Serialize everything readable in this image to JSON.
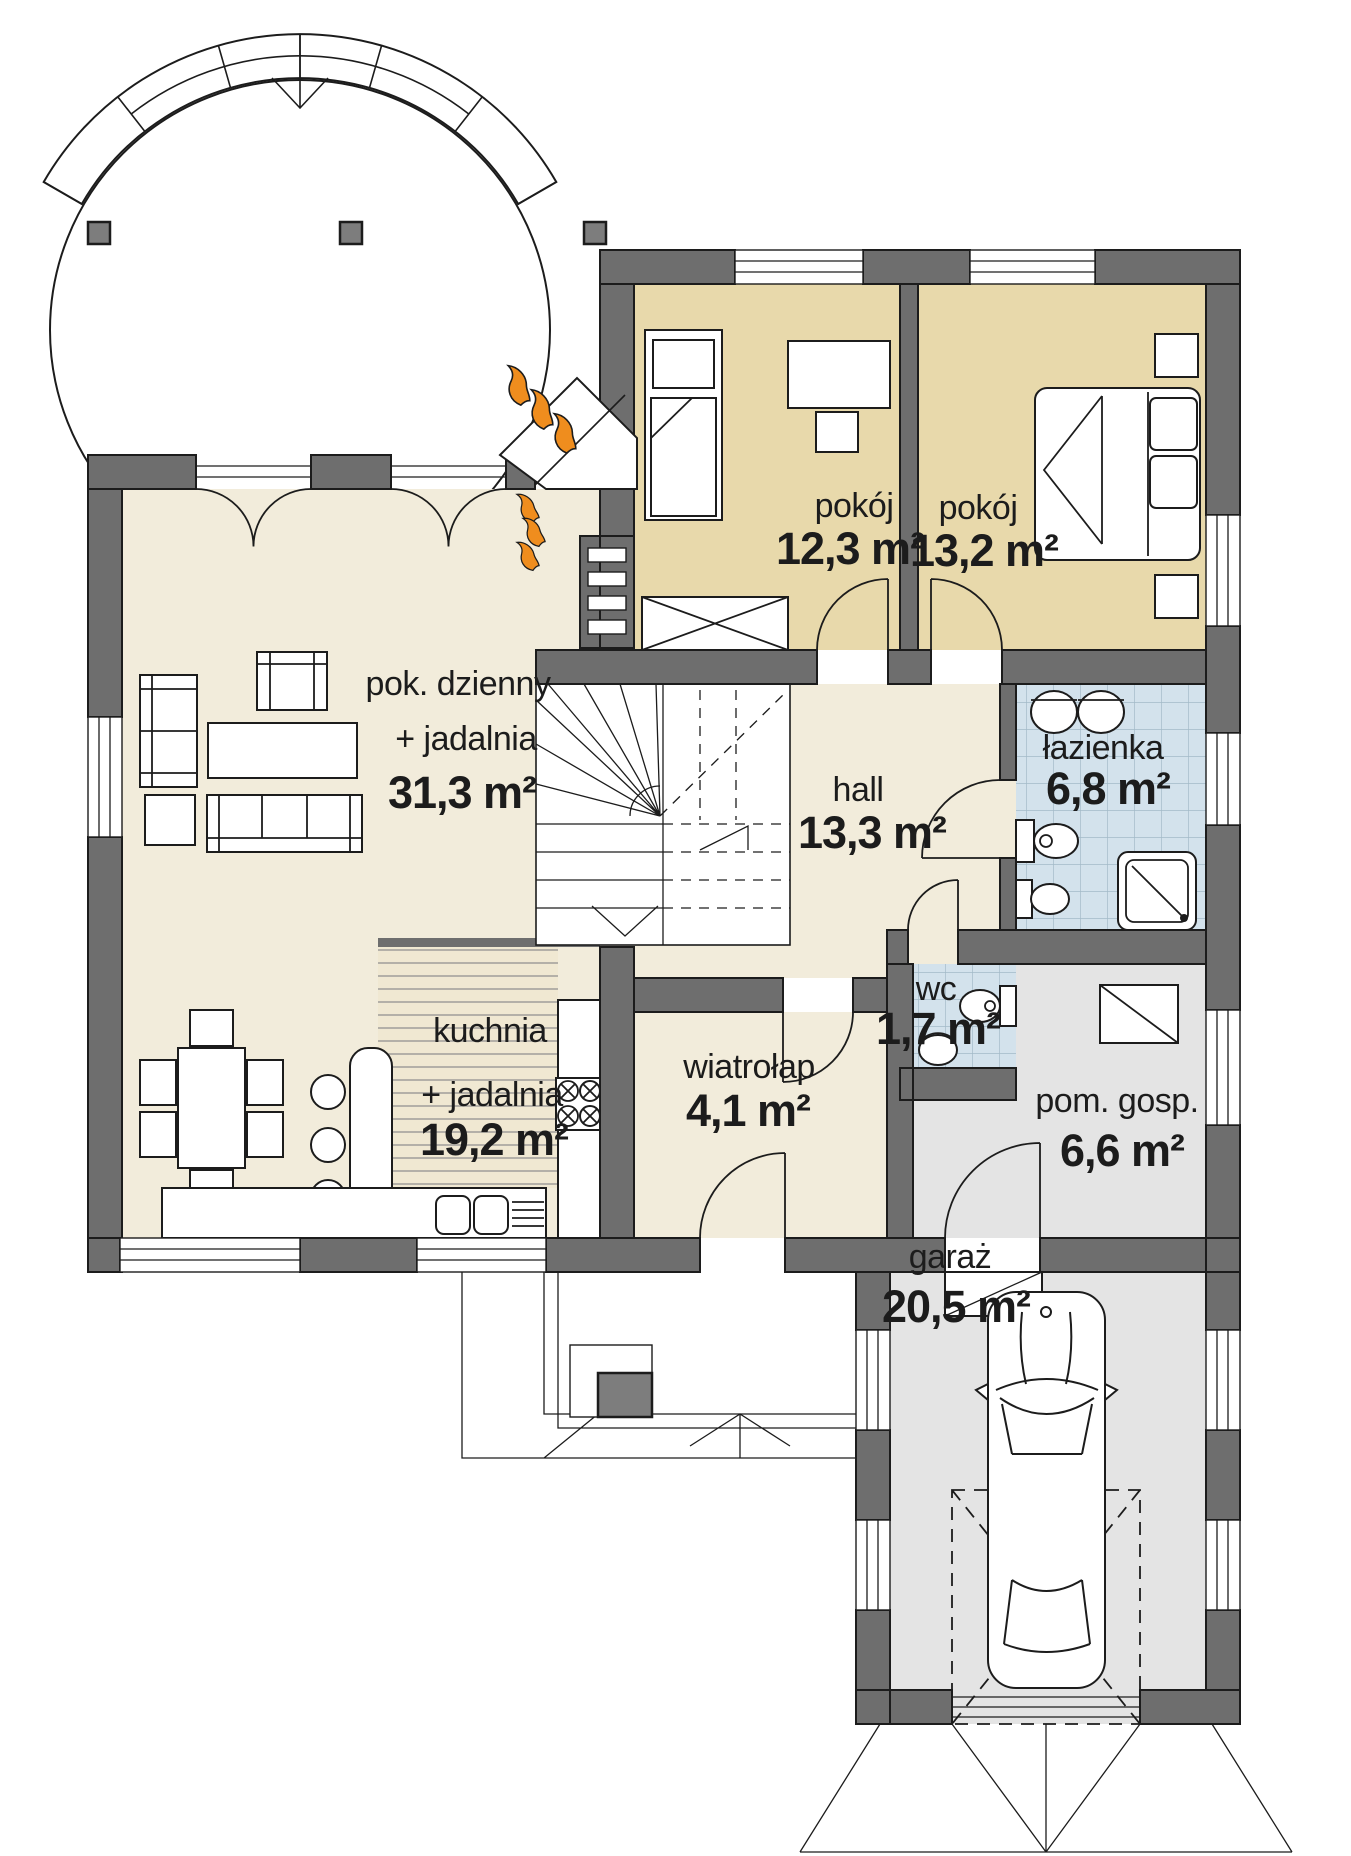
{
  "plan": {
    "type": "floor-plan",
    "language": "pl",
    "rooms": {
      "living": {
        "name": "pok. dzienny",
        "name2": "+ jadalnia",
        "area": "31,3 m²"
      },
      "kitchen": {
        "name": "kuchnia",
        "name2": "+ jadalnia",
        "area": "19,2 m²"
      },
      "room1": {
        "name": "pokój",
        "area": "12,3 m²"
      },
      "room2": {
        "name": "pokój",
        "area": "13,2 m²"
      },
      "hall": {
        "name": "hall",
        "area": "13,3 m²"
      },
      "bathroom": {
        "name": "łazienka",
        "area": "6,8 m²"
      },
      "wc": {
        "name": "wc",
        "area": "1,7 m²"
      },
      "utility": {
        "name": "pom. gosp.",
        "area": "6,6 m²"
      },
      "vestibule": {
        "name": "wiatrołap",
        "area": "4,1 m²"
      },
      "garage": {
        "name": "garaż",
        "area": "20,5 m²"
      }
    },
    "colors": {
      "wall": "#6e6e6e",
      "floor_main": "#f2ecdb",
      "floor_bedroom": "#e8d9ab",
      "floor_tile": "#d3e2ec",
      "floor_utility": "#e4e4e4",
      "kitchen_stripes": "#f0e8d2",
      "flame": "#ef8d1e"
    },
    "icons": {
      "heat": "flame-icon",
      "stairs": "stairs-symbol",
      "car": "car-top-view"
    }
  }
}
